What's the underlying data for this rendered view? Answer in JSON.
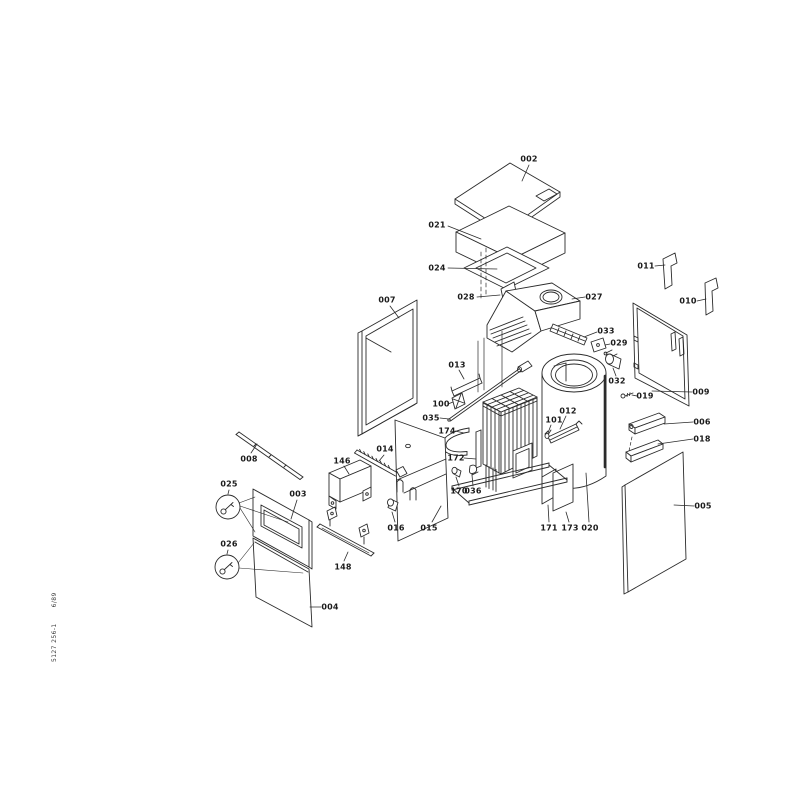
{
  "document": {
    "number": "5127 256-1",
    "date": "6/89"
  },
  "parts": [
    {
      "label": "002",
      "x": 529,
      "y": 159,
      "leader": [
        529,
        165,
        522,
        181
      ]
    },
    {
      "label": "021",
      "x": 437,
      "y": 225,
      "leader": [
        448,
        226,
        481,
        239
      ]
    },
    {
      "label": "024",
      "x": 437,
      "y": 268,
      "leader": [
        448,
        268,
        497,
        269
      ]
    },
    {
      "label": "028",
      "x": 466,
      "y": 297,
      "leader": [
        477,
        297,
        500,
        295
      ]
    },
    {
      "label": "027",
      "x": 594,
      "y": 297,
      "leader": [
        585,
        297,
        572,
        299
      ]
    },
    {
      "label": "033",
      "x": 606,
      "y": 331,
      "leader": [
        597,
        332,
        584,
        337
      ]
    },
    {
      "label": "029",
      "x": 619,
      "y": 343,
      "leader": [
        610,
        344,
        605,
        345
      ]
    },
    {
      "label": "032",
      "x": 617,
      "y": 381,
      "leader": [
        616,
        376,
        613,
        368
      ]
    },
    {
      "label": "013",
      "x": 457,
      "y": 365,
      "leader": [
        459,
        370,
        464,
        379
      ]
    },
    {
      "label": "100",
      "x": 441,
      "y": 404,
      "leader": [
        448,
        404,
        453,
        402
      ]
    },
    {
      "label": "035",
      "x": 431,
      "y": 418,
      "leader": [
        440,
        418,
        449,
        419
      ]
    },
    {
      "label": "174",
      "x": 447,
      "y": 431,
      "leader": [
        455,
        431,
        464,
        433
      ]
    },
    {
      "label": "172",
      "x": 456,
      "y": 458,
      "leader": [
        464,
        458,
        476,
        459
      ]
    },
    {
      "label": "170",
      "x": 459,
      "y": 491,
      "leader": [
        459,
        486,
        456,
        477
      ]
    },
    {
      "label": "036",
      "x": 473,
      "y": 491,
      "leader": [
        473,
        486,
        472,
        475
      ]
    },
    {
      "label": "012",
      "x": 568,
      "y": 411,
      "leader": [
        566,
        416,
        560,
        429
      ]
    },
    {
      "label": "101",
      "x": 554,
      "y": 420,
      "leader": [
        551,
        425,
        548,
        433
      ]
    },
    {
      "label": "171",
      "x": 549,
      "y": 528,
      "leader": [
        549,
        522,
        548,
        505
      ]
    },
    {
      "label": "173",
      "x": 570,
      "y": 528,
      "leader": [
        569,
        522,
        566,
        512
      ]
    },
    {
      "label": "020",
      "x": 590,
      "y": 528,
      "leader": [
        589,
        522,
        586,
        473
      ]
    },
    {
      "label": "011",
      "x": 646,
      "y": 266,
      "leader": [
        655,
        266,
        665,
        265
      ]
    },
    {
      "label": "010",
      "x": 688,
      "y": 301,
      "leader": [
        697,
        301,
        706,
        299
      ]
    },
    {
      "label": "009",
      "x": 701,
      "y": 392,
      "leader": [
        692,
        392,
        652,
        391
      ]
    },
    {
      "label": "019",
      "x": 645,
      "y": 396,
      "leader": [
        637,
        396,
        632,
        395
      ]
    },
    {
      "label": "006",
      "x": 702,
      "y": 422,
      "leader": [
        693,
        422,
        664,
        424
      ]
    },
    {
      "label": "018",
      "x": 702,
      "y": 439,
      "leader": [
        693,
        439,
        658,
        444
      ]
    },
    {
      "label": "005",
      "x": 703,
      "y": 506,
      "leader": [
        694,
        506,
        674,
        505
      ]
    },
    {
      "label": "007",
      "x": 387,
      "y": 300,
      "leader": [
        390,
        306,
        399,
        318
      ]
    },
    {
      "label": "008",
      "x": 249,
      "y": 459,
      "leader": [
        251,
        453,
        257,
        444
      ]
    },
    {
      "label": "014",
      "x": 385,
      "y": 449,
      "leader": [
        384,
        455,
        379,
        461
      ]
    },
    {
      "label": "146",
      "x": 342,
      "y": 461,
      "leader": [
        344,
        466,
        349,
        474
      ]
    },
    {
      "label": "148",
      "x": 343,
      "y": 567,
      "leader": [
        344,
        561,
        348,
        552
      ]
    },
    {
      "label": "016",
      "x": 396,
      "y": 528,
      "leader": [
        395,
        522,
        392,
        512
      ]
    },
    {
      "label": "015",
      "x": 429,
      "y": 528,
      "leader": [
        432,
        522,
        441,
        506
      ]
    },
    {
      "label": "025",
      "x": 229,
      "y": 484,
      "leader": [
        229,
        490,
        228,
        494
      ]
    },
    {
      "label": "003",
      "x": 298,
      "y": 494,
      "leader": [
        297,
        500,
        291,
        519
      ]
    },
    {
      "label": "026",
      "x": 229,
      "y": 544,
      "leader": [
        228,
        550,
        227,
        554
      ]
    },
    {
      "label": "004",
      "x": 330,
      "y": 607,
      "leader": [
        321,
        607,
        310,
        607
      ]
    }
  ]
}
